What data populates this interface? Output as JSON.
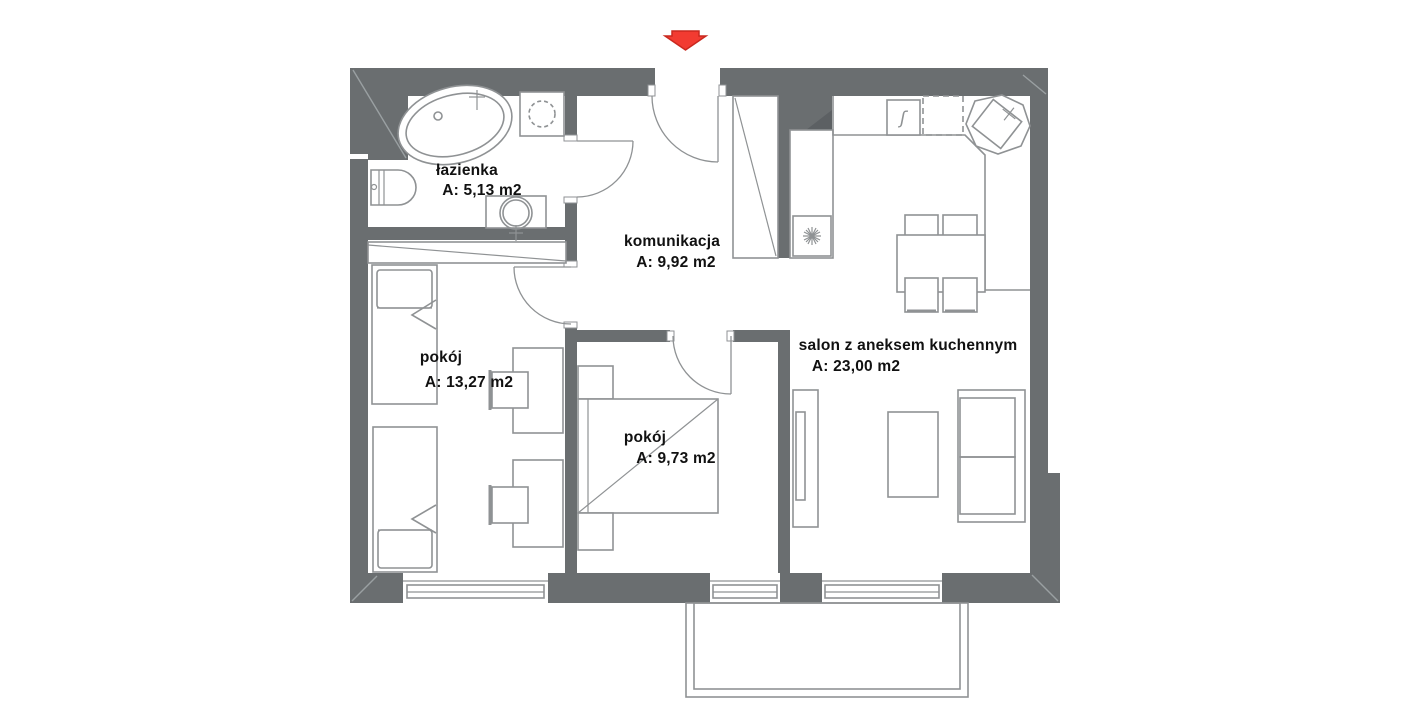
{
  "plan": {
    "colors": {
      "wall": "#6a6e70",
      "furniture_line": "#8f9294",
      "label": "#111111",
      "arrow_fill": "#f23b31",
      "arrow_border": "#c9281f"
    },
    "symbols": {
      "gas_appliance": "ʃ"
    },
    "rooms": [
      {
        "id": "lazienka",
        "name": "łazienka",
        "area": "A: 5,13 m2"
      },
      {
        "id": "komunikacja",
        "name": "komunikacja",
        "area": "A: 9,92 m2"
      },
      {
        "id": "pokoj-duzy",
        "name": "pokój",
        "area": "A: 13,27 m2"
      },
      {
        "id": "pokoj-maly",
        "name": "pokój",
        "area": "A: 9,73 m2"
      },
      {
        "id": "salon",
        "name": "salon z aneksem kuchennym",
        "area": "A: 23,00 m2"
      }
    ]
  }
}
